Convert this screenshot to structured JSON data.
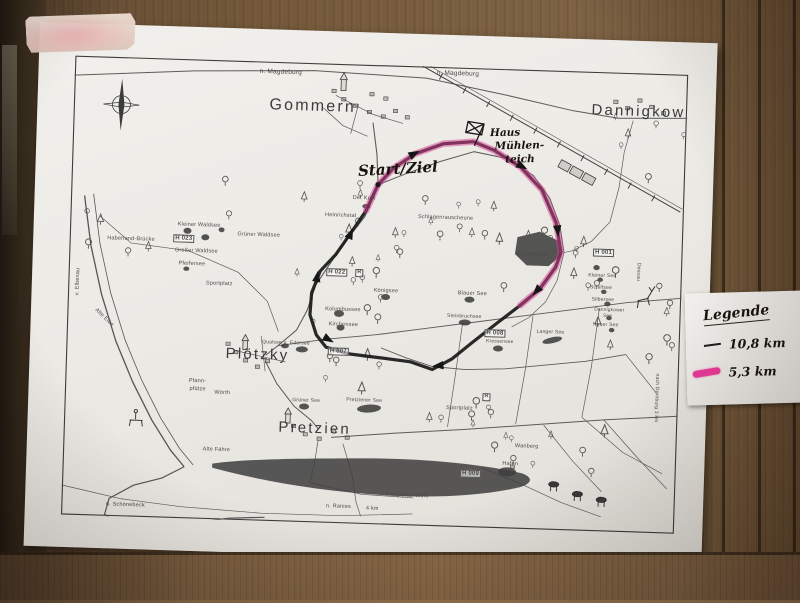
{
  "colors": {
    "route_black": "#181818",
    "route_pink": "#d83f92",
    "paper": "#eceae5",
    "wood": "#6d5339",
    "legend_pink": "#e83a98"
  },
  "annotations": {
    "start_ziel": "Start/Ziel",
    "haus1": "Haus",
    "haus2": "Mühlen-",
    "haus3": "teich"
  },
  "legend": {
    "title": "Legende",
    "items": [
      {
        "label": "10,8 km",
        "swatch": "black-line"
      },
      {
        "label": "5,3 km",
        "swatch": "pink-line"
      }
    ]
  },
  "map": {
    "labels": [
      {
        "t": "Gommern",
        "x": 196,
        "y": 36,
        "c": "town",
        "s": 16
      },
      {
        "t": "Dannigkow",
        "x": 518,
        "y": 31,
        "c": "town",
        "s": 15
      },
      {
        "t": "Plötzky",
        "x": 160,
        "y": 286,
        "c": "town",
        "s": 15
      },
      {
        "t": "Pretzien",
        "x": 215,
        "y": 358,
        "c": "town",
        "s": 15
      },
      {
        "t": "n. Magdeburg",
        "x": 185,
        "y": 8
      },
      {
        "t": "n. Magdeburg",
        "x": 362,
        "y": 4
      },
      {
        "t": "Der Kulk",
        "x": 282,
        "y": 132,
        "s": 5.5
      },
      {
        "t": "Heinrichstal",
        "x": 255,
        "y": 150,
        "s": 5.5
      },
      {
        "t": "Schlagenrauscheune",
        "x": 348,
        "y": 149,
        "s": 5.5
      },
      {
        "t": "Kleiner Waldsee",
        "x": 108,
        "y": 164,
        "s": 5.5
      },
      {
        "t": "H 023",
        "x": 104,
        "y": 176,
        "s": 6,
        "c": "marker"
      },
      {
        "t": "Großer Waldsee",
        "x": 106,
        "y": 190,
        "s": 5.5
      },
      {
        "t": "Grüner Waldsee",
        "x": 168,
        "y": 172,
        "s": 5.5
      },
      {
        "t": "Pfeifersee",
        "x": 110,
        "y": 203,
        "s": 5.5
      },
      {
        "t": "Haberland-Brücke",
        "x": 38,
        "y": 180,
        "s": 5.5
      },
      {
        "t": "v. Elbenau",
        "x": 8,
        "y": 240,
        "s": 5.5,
        "r": -90
      },
      {
        "t": "Alte Elbe",
        "x": 30,
        "y": 252,
        "s": 5.5,
        "r": 42
      },
      {
        "t": "Sportplatz",
        "x": 138,
        "y": 222,
        "s": 5.5
      },
      {
        "t": "H 022",
        "x": 258,
        "y": 205,
        "s": 6,
        "c": "marker"
      },
      {
        "t": "R",
        "x": 287,
        "y": 205,
        "s": 5.5,
        "c": "marker"
      },
      {
        "t": "Königsee",
        "x": 306,
        "y": 224,
        "s": 5.5
      },
      {
        "t": "Kolumbussee",
        "x": 258,
        "y": 244,
        "s": 5.5
      },
      {
        "t": "Kirchensee",
        "x": 262,
        "y": 259,
        "s": 5.5
      },
      {
        "t": "Qualsee u. Edersee",
        "x": 196,
        "y": 279,
        "s": 5
      },
      {
        "t": "H 007",
        "x": 262,
        "y": 284,
        "s": 6,
        "c": "marker"
      },
      {
        "t": "Plattensee",
        "x": 448,
        "y": 182,
        "s": 6
      },
      {
        "t": "H 001",
        "x": 524,
        "y": 177,
        "s": 6,
        "c": "marker"
      },
      {
        "t": "Kleiner See",
        "x": 520,
        "y": 202,
        "s": 5
      },
      {
        "t": "Schilfsee",
        "x": 522,
        "y": 214,
        "s": 5
      },
      {
        "t": "Silbersee",
        "x": 524,
        "y": 226,
        "s": 5
      },
      {
        "t": "Dannigkower",
        "x": 527,
        "y": 237,
        "s": 4.8
      },
      {
        "t": "See",
        "x": 536,
        "y": 243,
        "s": 4.8
      },
      {
        "t": "Neuer See",
        "x": 526,
        "y": 251,
        "s": 5
      },
      {
        "t": "Blauer See",
        "x": 390,
        "y": 224,
        "s": 5.5
      },
      {
        "t": "Steinbruchsee",
        "x": 380,
        "y": 247,
        "s": 5
      },
      {
        "t": "H 008",
        "x": 418,
        "y": 261,
        "s": 6,
        "c": "marker"
      },
      {
        "t": "Kressensee",
        "x": 420,
        "y": 272,
        "s": 4.8
      },
      {
        "t": "Langer See",
        "x": 470,
        "y": 260,
        "s": 5
      },
      {
        "t": "Grüner See",
        "x": 228,
        "y": 336,
        "s": 5
      },
      {
        "t": "Pretziener See",
        "x": 282,
        "y": 334,
        "s": 5
      },
      {
        "t": "Sportplatz",
        "x": 382,
        "y": 339,
        "s": 5.5
      },
      {
        "t": "R",
        "x": 418,
        "y": 325,
        "s": 5.5,
        "c": "marker"
      },
      {
        "t": "Pfann-",
        "x": 124,
        "y": 320,
        "s": 5.5
      },
      {
        "t": "pfütze",
        "x": 125,
        "y": 328,
        "s": 5.5
      },
      {
        "t": "Wörth",
        "x": 150,
        "y": 331,
        "s": 5.5
      },
      {
        "t": "Alte Fähre",
        "x": 140,
        "y": 388,
        "s": 5.5
      },
      {
        "t": "Wanberg",
        "x": 452,
        "y": 375,
        "s": 5.5
      },
      {
        "t": "H 009",
        "x": 398,
        "y": 402,
        "s": 6,
        "c": "marker"
      },
      {
        "t": "Hafen",
        "x": 440,
        "y": 393,
        "s": 5.5
      },
      {
        "t": "Pretziener Wehr",
        "x": 325,
        "y": 428,
        "s": 5.5
      },
      {
        "t": "n. Schönebeck",
        "x": 45,
        "y": 446,
        "s": 5.5
      },
      {
        "t": "n. Ranies",
        "x": 265,
        "y": 441,
        "s": 5.5
      },
      {
        "t": "4 km",
        "x": 305,
        "y": 442,
        "s": 5.5
      },
      {
        "t": "nach Dornburg 3 km",
        "x": 594,
        "y": 300,
        "s": 5,
        "r": 90
      },
      {
        "t": "Dessau",
        "x": 572,
        "y": 190,
        "s": 5,
        "r": 90
      }
    ]
  }
}
